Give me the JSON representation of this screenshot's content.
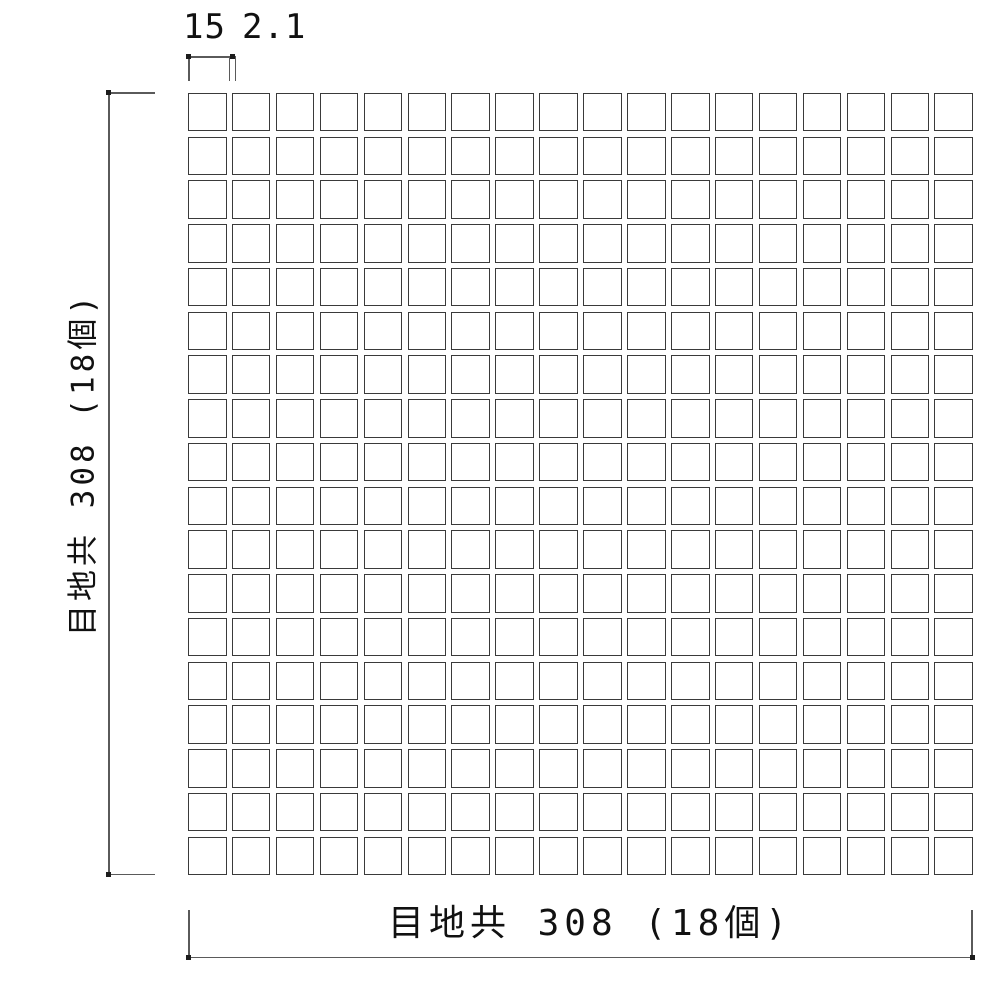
{
  "drawing": {
    "top_dimension": {
      "tile_width_label": "15",
      "joint_width_label": "2.1"
    },
    "left_dimension": {
      "label": "目地共 308 (18個)"
    },
    "bottom_dimension": {
      "label": "目地共 308 (18個)"
    },
    "grid": {
      "rows": 18,
      "columns": 18
    },
    "colors": {
      "background": "#ffffff",
      "dimension_line": "#5a5a5a",
      "tile_border": "#3a3a3a",
      "text": "#111111"
    }
  }
}
